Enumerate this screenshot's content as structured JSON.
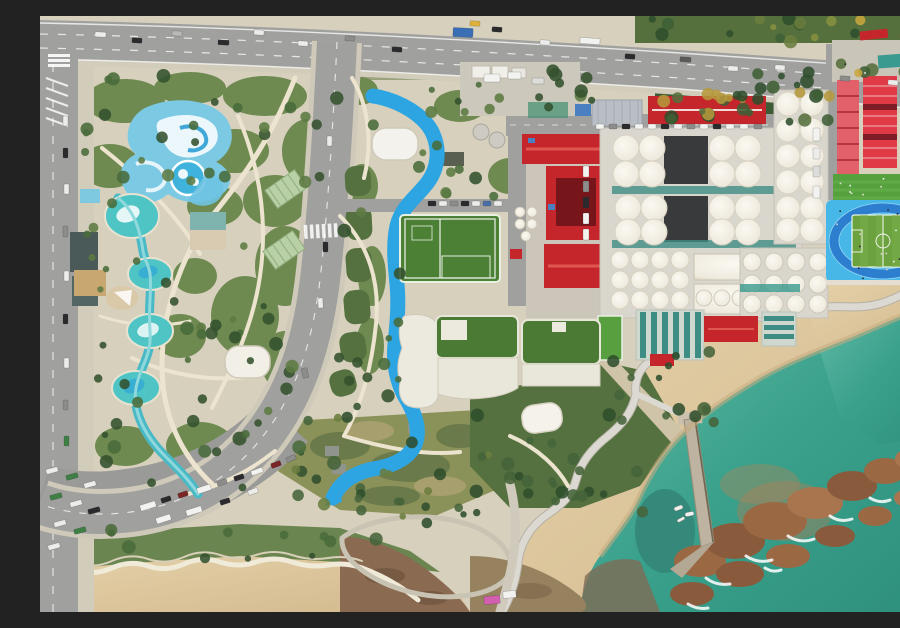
{
  "scene": {
    "description": "Aerial drone photograph of a seaside leisure and industrial district: a water park with chained teal pools and swirl pools on the left, a curved boulevard, a park crossed by a winding bright-blue jogging path and a green soccer pitch, a brewery complex with red hip roofs and rows of white fermentation tanks, a school campus with pink buildings, a lawn and a blue running-track field on the right, and a coastline with sandy beaches, a wavy boardwalk, a concrete pier, reddish surf rocks and teal sea water."
  },
  "palette": {
    "ocean1": "#5ebba4",
    "ocean2": "#2f9480",
    "sand1": "#e6d2ab",
    "sand2": "#d2b98d",
    "sandWet": "#c9ab80",
    "rock": "#9b6844",
    "rockDark": "#8a5a3c",
    "road": "#a0a09e",
    "roadDark": "#9a9a98",
    "sidewalk": "#d2ccbb",
    "parkBase": "#d6d0bd",
    "parkPath": "#ece4cf",
    "green1": "#6f8a50",
    "green2": "#55713f",
    "lawnOlive": "#8a9159",
    "treeDark": "#33512e",
    "turf": "#4c8034",
    "bluePath": "#2da5e2",
    "poolTeal": "#4fc4c4",
    "poolLight": "#7cc9e4",
    "redRoof": "#c5262b",
    "redRoofDark": "#77161a",
    "pink1": "#e2606a",
    "pink2": "#e03a46",
    "grayRoof": "#b9bdc4",
    "tankBase": "#d9d6cd",
    "darkRoof": "#2b2d2f",
    "tealBasin": "#3e8d85",
    "trackBlue": "#47b7e8",
    "laneBlue": "#2e7ecf",
    "schoolLawn": "#55a13e",
    "pitchGreen": "#6ba23e",
    "white": "#f2f0e8"
  },
  "vehicles": [
    [
      55,
      16,
      11,
      5,
      "#ececea",
      3
    ],
    [
      92,
      22,
      10,
      5,
      "#2b2b2d",
      3
    ],
    [
      132,
      15,
      10,
      5,
      "#b8b8b6",
      3
    ],
    [
      178,
      24,
      11,
      5,
      "#2b2b2d",
      3
    ],
    [
      214,
      14,
      10,
      5,
      "#ececea",
      3
    ],
    [
      258,
      25,
      10,
      5,
      "#ececea",
      3
    ],
    [
      305,
      20,
      10,
      5,
      "#8c8c8a",
      3
    ],
    [
      352,
      31,
      10,
      5,
      "#2b2b2d",
      3
    ],
    [
      413,
      12,
      20,
      9,
      "#3a6fb5",
      3
    ],
    [
      430,
      5,
      10,
      5,
      "#e0b23c",
      3
    ],
    [
      452,
      11,
      10,
      5,
      "#2b2b2d",
      4
    ],
    [
      500,
      24,
      10,
      5,
      "#ececea",
      4
    ],
    [
      540,
      22,
      20,
      6,
      "#f2f2f0",
      4
    ],
    [
      585,
      38,
      10,
      5,
      "#2b2b2d",
      4
    ],
    [
      640,
      41,
      11,
      5,
      "#5a5a58",
      4
    ],
    [
      688,
      50,
      10,
      5,
      "#ececea",
      4
    ],
    [
      735,
      49,
      10,
      5,
      "#ececea",
      4
    ],
    [
      800,
      60,
      10,
      5,
      "#8c8c8a",
      4
    ],
    [
      848,
      64,
      10,
      5,
      "#ececea",
      4
    ],
    [
      23,
      100,
      5,
      10,
      "#ececea",
      0
    ],
    [
      23,
      132,
      5,
      10,
      "#2b2b2d",
      0
    ],
    [
      24,
      168,
      5,
      10,
      "#ececea",
      0
    ],
    [
      23,
      210,
      5,
      11,
      "#8c8c8a",
      0
    ],
    [
      24,
      255,
      5,
      10,
      "#ececea",
      0
    ],
    [
      23,
      298,
      5,
      10,
      "#2b2b2d",
      0
    ],
    [
      24,
      342,
      5,
      10,
      "#ececea",
      0
    ],
    [
      23,
      384,
      5,
      10,
      "#8c8c8a",
      0
    ],
    [
      24,
      420,
      5,
      10,
      "#3f7f46",
      0
    ],
    [
      6,
      452,
      12,
      5,
      "#ececea",
      -15
    ],
    [
      26,
      458,
      12,
      5,
      "#3f7f46",
      -15
    ],
    [
      44,
      466,
      12,
      5,
      "#ececea",
      -15
    ],
    [
      10,
      478,
      12,
      5,
      "#3f7f46",
      -15
    ],
    [
      30,
      485,
      12,
      5,
      "#ececea",
      -15
    ],
    [
      48,
      492,
      12,
      5,
      "#2b2b2d",
      -15
    ],
    [
      14,
      505,
      12,
      5,
      "#ececea",
      -15
    ],
    [
      34,
      512,
      12,
      5,
      "#3f7f46",
      -15
    ],
    [
      8,
      528,
      12,
      5,
      "#ececea",
      -15
    ],
    [
      100,
      487,
      16,
      6,
      "#f2f2f0",
      -18
    ],
    [
      121,
      481,
      10,
      5,
      "#2b2b2d",
      -18
    ],
    [
      138,
      476,
      10,
      5,
      "#7a2626",
      -18
    ],
    [
      157,
      470,
      14,
      6,
      "#f2f2f0",
      -18
    ],
    [
      177,
      464,
      10,
      5,
      "#8c8c8a",
      -18
    ],
    [
      194,
      459,
      10,
      5,
      "#2b2b2d",
      -18
    ],
    [
      211,
      453,
      12,
      5,
      "#f2f2f0",
      -20
    ],
    [
      231,
      446,
      10,
      5,
      "#7a2626",
      -20
    ],
    [
      116,
      500,
      15,
      6,
      "#f2f2f0",
      -18
    ],
    [
      146,
      492,
      16,
      6,
      "#f2f2f0",
      -18
    ],
    [
      180,
      483,
      10,
      5,
      "#2b2b2d",
      -18
    ],
    [
      208,
      473,
      10,
      5,
      "#ececea",
      -20
    ],
    [
      246,
      440,
      10,
      5,
      "#8c8c8a",
      -24
    ],
    [
      287,
      120,
      5,
      10,
      "#ececea",
      0
    ],
    [
      283,
      226,
      5,
      10,
      "#2b2b2d",
      0
    ],
    [
      278,
      282,
      5,
      10,
      "#ececea",
      -3
    ],
    [
      262,
      352,
      6,
      10,
      "#8c8c8a",
      -12
    ],
    [
      388,
      185,
      8,
      5,
      "#2b2b2d",
      0
    ],
    [
      399,
      185,
      8,
      5,
      "#ececea",
      0
    ],
    [
      410,
      185,
      8,
      5,
      "#8c8c8a",
      0
    ],
    [
      421,
      185,
      8,
      5,
      "#2b2b2d",
      0
    ],
    [
      432,
      185,
      8,
      5,
      "#ececea",
      0
    ],
    [
      443,
      185,
      8,
      5,
      "#4a6fa5",
      0
    ],
    [
      454,
      185,
      8,
      5,
      "#ececea",
      0
    ],
    [
      543,
      150,
      6,
      11,
      "#f2f2f0",
      0
    ],
    [
      543,
      165,
      6,
      11,
      "#8c8c8a",
      0
    ],
    [
      543,
      181,
      6,
      11,
      "#2b2b2d",
      0
    ],
    [
      543,
      197,
      6,
      11,
      "#f2f2f0",
      0
    ],
    [
      543,
      213,
      6,
      11,
      "#f2f2f0",
      0
    ],
    [
      556,
      108,
      8,
      5,
      "#f2f2f0",
      0
    ],
    [
      569,
      108,
      8,
      5,
      "#8c8c8a",
      0
    ],
    [
      582,
      108,
      8,
      5,
      "#2b2b2d",
      0
    ],
    [
      595,
      108,
      8,
      5,
      "#f2f2f0",
      0
    ],
    [
      608,
      108,
      8,
      5,
      "#f2f2f0",
      0
    ],
    [
      621,
      108,
      8,
      5,
      "#2b2b2d",
      0
    ],
    [
      634,
      108,
      8,
      5,
      "#f2f2f0",
      0
    ],
    [
      647,
      108,
      8,
      5,
      "#8c8c8a",
      0
    ],
    [
      660,
      108,
      8,
      5,
      "#f2f2f0",
      0
    ],
    [
      673,
      108,
      8,
      5,
      "#2b2b2d",
      0
    ],
    [
      686,
      108,
      8,
      5,
      "#f2f2f0",
      0
    ],
    [
      700,
      108,
      8,
      5,
      "#f2f2f0",
      0
    ],
    [
      714,
      108,
      8,
      5,
      "#8c8c8a",
      0
    ],
    [
      444,
      58,
      16,
      8,
      "#f2f2f0",
      0
    ],
    [
      468,
      56,
      13,
      7,
      "#f2f2f0",
      0
    ],
    [
      492,
      62,
      12,
      6,
      "#dcdcda",
      0
    ],
    [
      773,
      112,
      7,
      13,
      "#f2f2f0",
      0
    ],
    [
      773,
      132,
      7,
      11,
      "#ececea",
      0
    ],
    [
      773,
      150,
      7,
      11,
      "#dcdcda",
      0
    ],
    [
      773,
      170,
      7,
      12,
      "#f2f2f0",
      0
    ],
    [
      444,
      580,
      16,
      8,
      "#d45fb0",
      -5
    ],
    [
      463,
      575,
      13,
      7,
      "#f2f2f0",
      -5
    ]
  ],
  "boats": [
    [
      634,
      490,
      9,
      4,
      -20
    ],
    [
      645,
      496,
      9,
      4,
      -12
    ],
    [
      637,
      502,
      8,
      3,
      -28
    ]
  ],
  "tree_clusters": [
    {
      "x": 600,
      "y": 0,
      "w": 300,
      "h": 26,
      "n": 18,
      "colors": [
        "#3f5e35",
        "#6b7d3f",
        "#c8a63e",
        "#88913f",
        "#2f4d2c"
      ]
    },
    {
      "x": 618,
      "y": 68,
      "w": 175,
      "h": 42,
      "n": 22,
      "colors": [
        "#2f4d2c",
        "#3f5e35",
        "#55703c",
        "#b5983c"
      ]
    },
    {
      "x": 793,
      "y": 40,
      "w": 105,
      "h": 20,
      "n": 8,
      "colors": [
        "#3f5e35",
        "#c8a63e",
        "#55703c"
      ]
    },
    {
      "x": 45,
      "y": 55,
      "w": 255,
      "h": 125,
      "n": 26,
      "colors": [
        "#33512e",
        "#496b3a",
        "#5c7a42"
      ]
    },
    {
      "x": 42,
      "y": 185,
      "w": 235,
      "h": 215,
      "n": 32,
      "colors": [
        "#33512e",
        "#496b3a",
        "#5c7a42"
      ]
    },
    {
      "x": 58,
      "y": 400,
      "w": 205,
      "h": 85,
      "n": 15,
      "colors": [
        "#33512e",
        "#496b3a"
      ]
    },
    {
      "x": 298,
      "y": 52,
      "w": 165,
      "h": 145,
      "n": 18,
      "colors": [
        "#33512e",
        "#496b3a",
        "#5c7a42"
      ]
    },
    {
      "x": 298,
      "y": 200,
      "w": 62,
      "h": 195,
      "n": 12,
      "colors": [
        "#33512e",
        "#496b3a"
      ]
    },
    {
      "x": 255,
      "y": 398,
      "w": 205,
      "h": 105,
      "n": 22,
      "colors": [
        "#2f4d2c",
        "#46633a",
        "#6b7d3f"
      ]
    },
    {
      "x": 455,
      "y": 400,
      "w": 150,
      "h": 108,
      "n": 20,
      "colors": [
        "#2f4d2c",
        "#46633a"
      ]
    },
    {
      "x": 560,
      "y": 330,
      "w": 115,
      "h": 80,
      "n": 14,
      "colors": [
        "#2f4d2c",
        "#46633a"
      ]
    },
    {
      "x": 488,
      "y": 52,
      "w": 72,
      "h": 40,
      "n": 9,
      "colors": [
        "#33512e",
        "#5c7a42"
      ]
    },
    {
      "x": 690,
      "y": 52,
      "w": 95,
      "h": 55,
      "n": 11,
      "colors": [
        "#2f4d2c",
        "#3f5e35"
      ]
    },
    {
      "x": 62,
      "y": 505,
      "w": 250,
      "h": 38,
      "n": 10,
      "colors": [
        "#33512e",
        "#496b3a"
      ]
    },
    {
      "x": 320,
      "y": 475,
      "w": 120,
      "h": 60,
      "n": 8,
      "colors": [
        "#2f4d2c",
        "#46633a"
      ]
    }
  ],
  "crowd_clusters": [
    {
      "x": 797,
      "y": 160,
      "w": 100,
      "h": 24,
      "n": 16,
      "colors": [
        "#f2f2f0",
        "#e8e0d0"
      ]
    },
    {
      "x": 792,
      "y": 188,
      "w": 106,
      "h": 74,
      "n": 24,
      "colors": [
        "#2b2b2d",
        "#f2f2f0",
        "#d8d8d6"
      ]
    },
    {
      "x": 800,
      "y": 45,
      "w": 90,
      "h": 14,
      "n": 6,
      "colors": [
        "#f2f2f0",
        "#2b2b2d"
      ]
    }
  ]
}
